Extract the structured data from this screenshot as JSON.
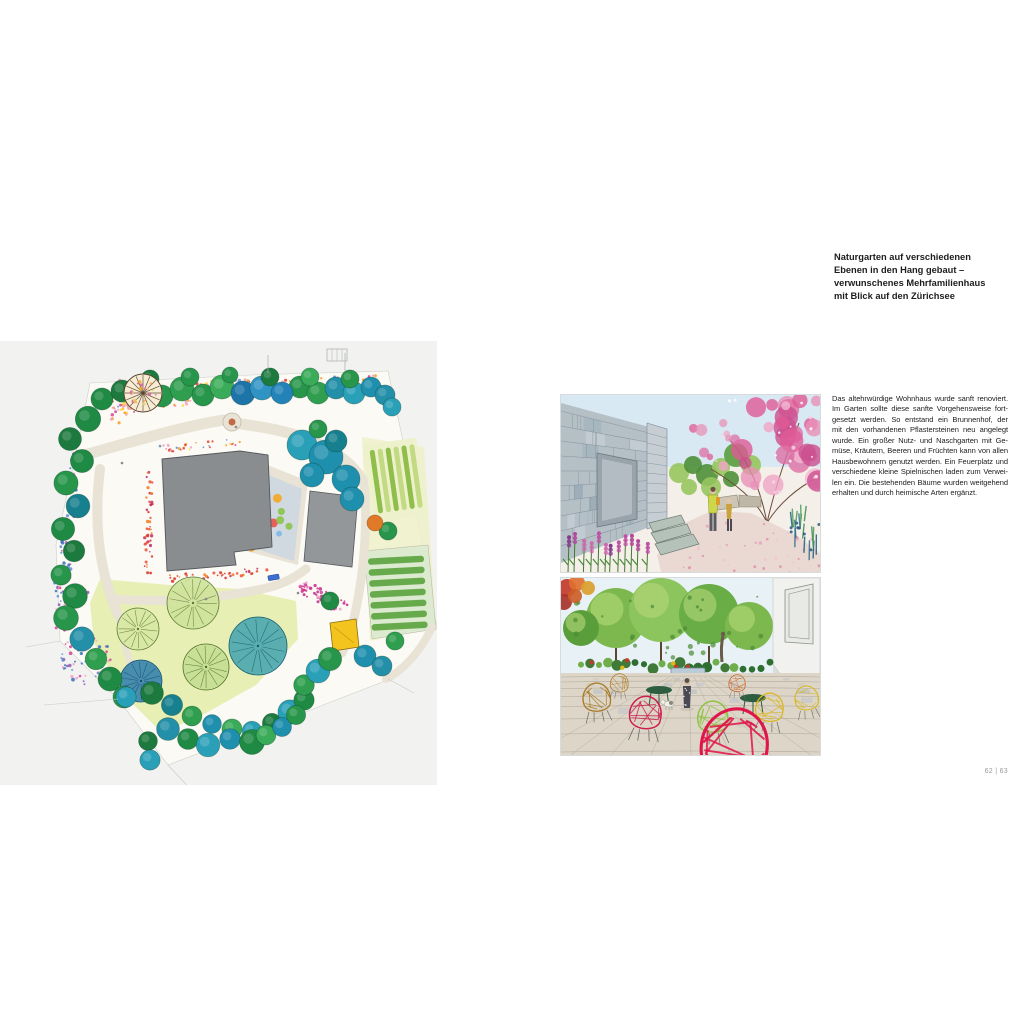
{
  "page": {
    "headline_lines": [
      "Naturgarten auf verschiedenen",
      "Ebenen in den Hang gebaut –",
      "verwunschenes Mehrfamilienhaus",
      "mit Blick auf den Zürichsee"
    ],
    "headline_text": "Naturgarten auf verschiedenen Ebenen in den Hang gebaut – verwunschenes Mehrfamilienhaus mit Blick auf den Zürichsee",
    "body_lines": [
      "Das altehrwürdige Wohnhaus wurde sanft renoviert.",
      "Im Garten sollte diese sanfte Vorgehensweise fort-",
      "gesetzt werden. So entstand ein Brunnenhof, der",
      "mit den vorhandenen Pflastersteinen neu angelegt",
      "wurde. Ein großer Nutz- und Naschgarten mit Ge-",
      "müse, Kräutern, Beeren und Früchten kann von allen",
      "Hausbewohnern genutzt werden. Ein Feuerplatz und",
      "verschiedene kleine Spielnischen laden zum Verwei-",
      "len ein. Die bestehenden Bäume wurden weitgehend",
      "erhalten und durch heimische Arten ergänzt."
    ],
    "body_text": "Das altehrwürdige Wohnhaus wurde sanft renoviert. Im Garten sollte diese sanfte Vorgehensweise fortgesetzt werden. So entstand ein Brunnenhof, der mit den vorhandenen Pflastersteinen neu angelegt wurde. Ein großer Nutz- und Naschgarten mit Gemüse, Kräutern, Beeren und Früchten kann von allen Hausbewohnern genutzt werden. Ein Feuerplatz und verschiedene kleine Spielnischen laden zum Verweilen ein. Die bestehenden Bäume wurden weitgehend erhalten und durch heimische Arten ergänzt.",
    "page_number": "62 | 63"
  },
  "figures": {
    "site_plan": "watercolor-garden-site-plan",
    "top_photo": "watercolor-stone-house-path-blossom-tree",
    "bottom_photo": "watercolor-courtyard-wire-chairs"
  },
  "colors": {
    "heading_text": "#1d1d1b",
    "body_text": "#1d1d1b",
    "page_number": "#9b9b9b",
    "background": "#ffffff",
    "plan_paper": "#f2f3f1"
  }
}
